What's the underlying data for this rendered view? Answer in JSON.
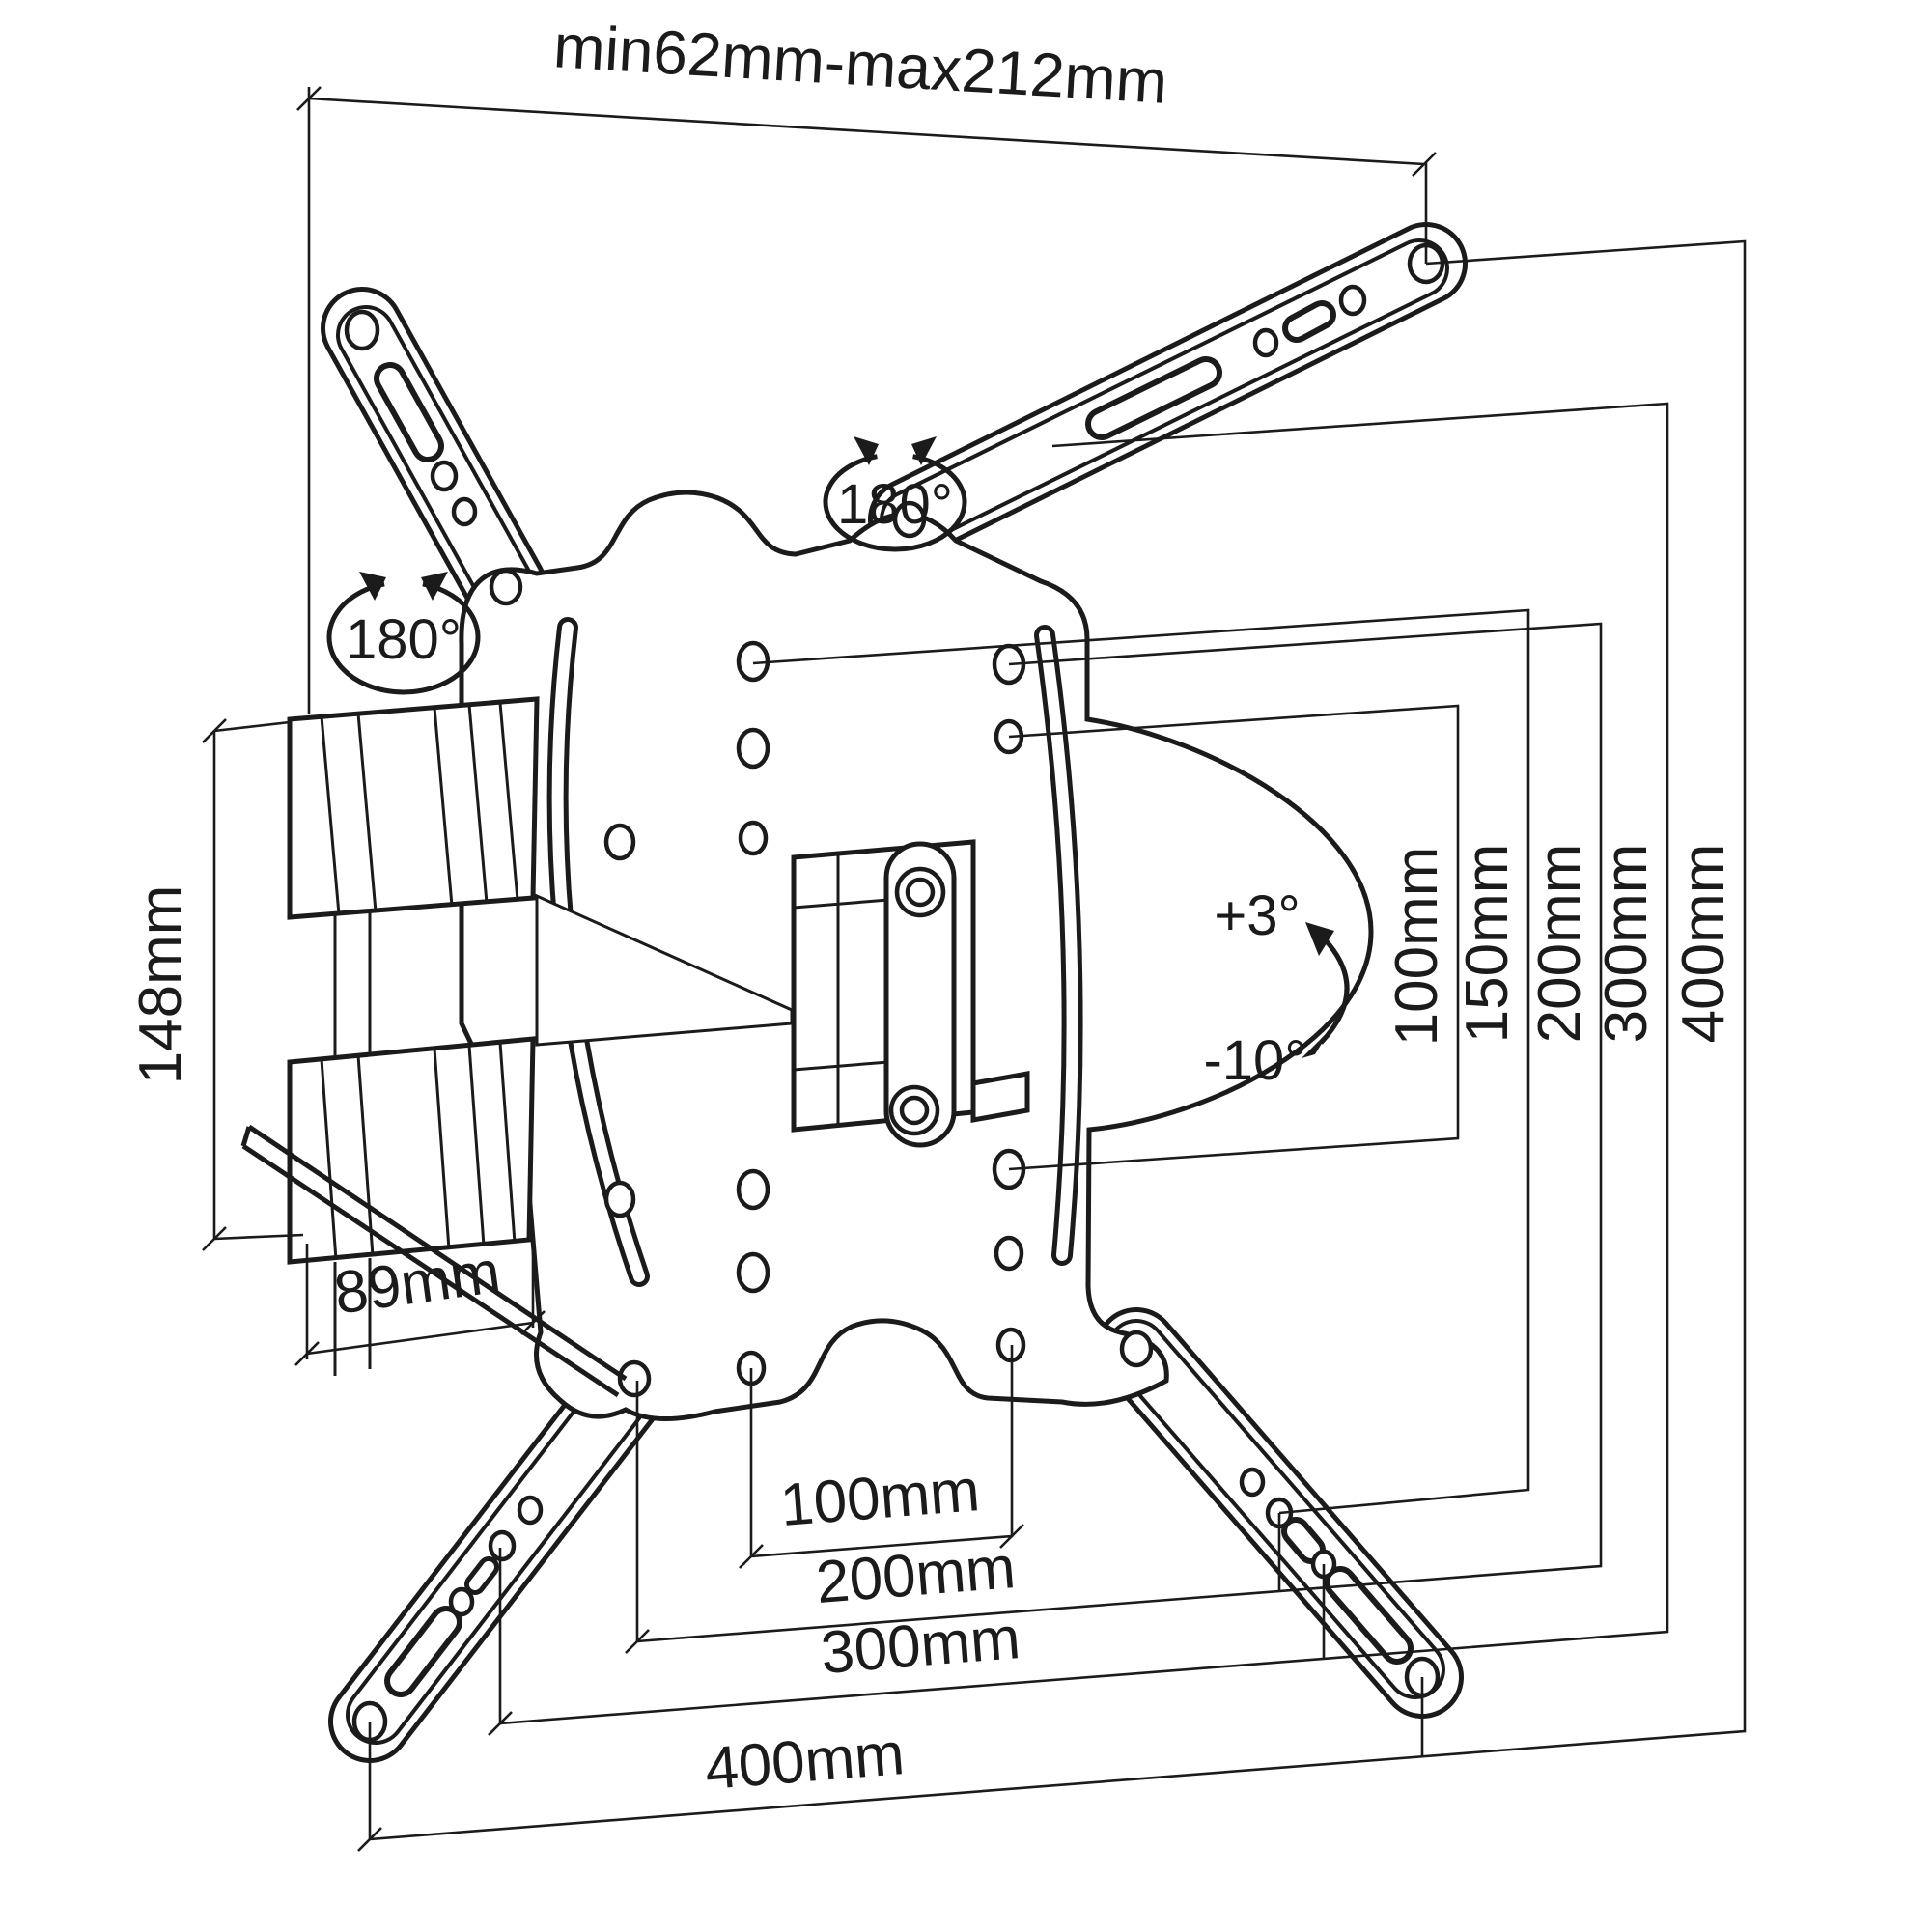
{
  "diagram": {
    "type": "technical-dimension-drawing",
    "subject": "Full-motion TV wall mount bracket with VESA plate, four extension arms and articulating wall arm",
    "background_color": "#ffffff",
    "line_color": "#1b1b1b",
    "annotations": {
      "top_span": "min62mm-max212mm",
      "bracket_height": "148mm",
      "bracket_depth": "89mm",
      "swivel_left": "180°",
      "swivel_top": "180°",
      "tilt_up": "+3°",
      "tilt_down": "-10°"
    },
    "vesa_heights": [
      "100mm",
      "150mm",
      "200mm",
      "300mm",
      "400mm"
    ],
    "vesa_widths": [
      "100mm",
      "200mm",
      "300mm",
      "400mm"
    ]
  }
}
